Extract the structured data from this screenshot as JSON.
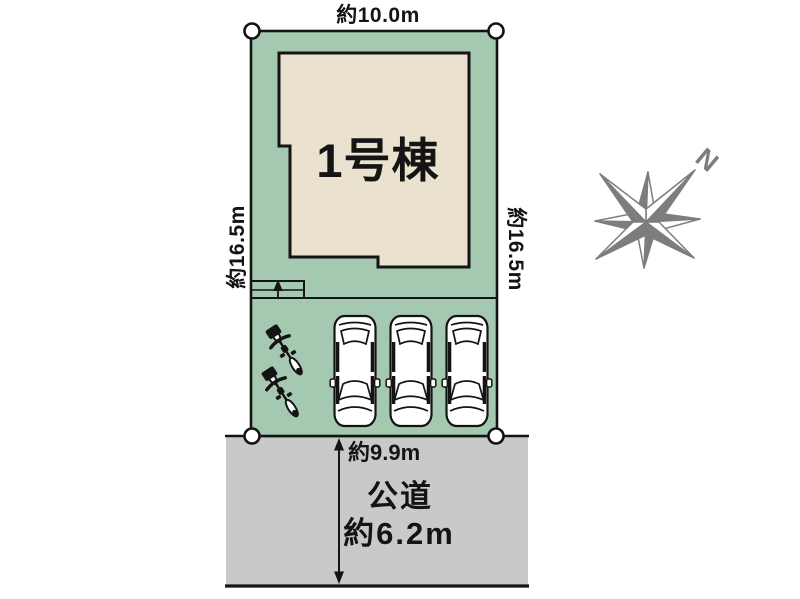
{
  "diagram": {
    "lot": {
      "building_label": "1号棟",
      "top_width": "約10.0m",
      "left_depth": "約16.5m",
      "right_depth": "約16.5m",
      "frontage": "約9.9m"
    },
    "road": {
      "name": "公道",
      "width": "約6.2m"
    },
    "compass": {
      "north_label": "N"
    },
    "counts": {
      "cars": 3,
      "bicycles": 2,
      "boundary_markers": 4
    }
  },
  "icons": {
    "compass": "compass-rose-icon",
    "car": "car-top-icon",
    "bicycle": "bicycle-top-icon",
    "boundary_marker": "boundary-point-icon",
    "road_arrow": "road-width-arrow-icon",
    "entrance_arrow": "entrance-step-arrow-icon"
  },
  "colors": {
    "lot": "#a5c8b1",
    "building": "#eae2cf",
    "road": "#c9c9c9",
    "outline": "#141414",
    "compass": "#7d7d7d",
    "background": "#ffffff"
  }
}
